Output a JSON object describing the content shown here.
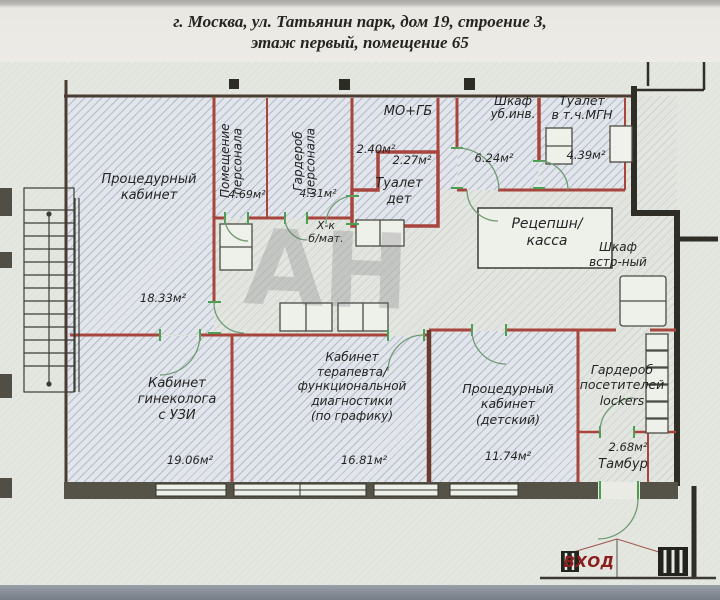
{
  "header": {
    "line1": "г. Москва, ул. Татьянин парк, дом 19, строение 3,",
    "line2": "этаж первый, помещение 65"
  },
  "rooms": [
    {
      "name": "Процедурный\nкабинет",
      "area": "18.33м²"
    },
    {
      "name": "Помещение\nперсонала",
      "area": "4.69м²"
    },
    {
      "name": "Гардероб\nперсонала",
      "area": "4.31м²"
    },
    {
      "name": "МО+ГБ",
      "area": "2.40м²"
    },
    {
      "name": "Туалет\nдет",
      "area": "2.27м²"
    },
    {
      "name": "Шкаф\nуб.инв.",
      "area": "6.24м²"
    },
    {
      "name": "Туалет\nв т.ч.МГН",
      "area": "4.39м²"
    },
    {
      "name": "Кабинет\nгинеколога\nс УЗИ",
      "area": "19.06м²"
    },
    {
      "name": "Кабинет\nтерапевта/\nфункциональной\nдиагностики\n(по графику)",
      "area": "16.81м²"
    },
    {
      "name": "Процедурный\nкабинет\n(детский)",
      "area": "11.74м²"
    },
    {
      "name": "Гардероб\nпосетителей\nlockers",
      "area": ""
    },
    {
      "name": "Тамбур",
      "area": "2.68м²"
    }
  ],
  "annotations": {
    "reception": "Рецепшн/\nкасса",
    "built_in_closet": "Шкаф\nвстр-ный",
    "fridge": "Х-к\nб/мат.",
    "entrance": "ВХОД",
    "watermark": "АН"
  },
  "colors": {
    "wall_red": "#a8453c",
    "wall_black": "#2e2d26",
    "door_green": "#49a050",
    "entrance_text": "#8c1e1e",
    "paper": "#e4e6e0"
  }
}
